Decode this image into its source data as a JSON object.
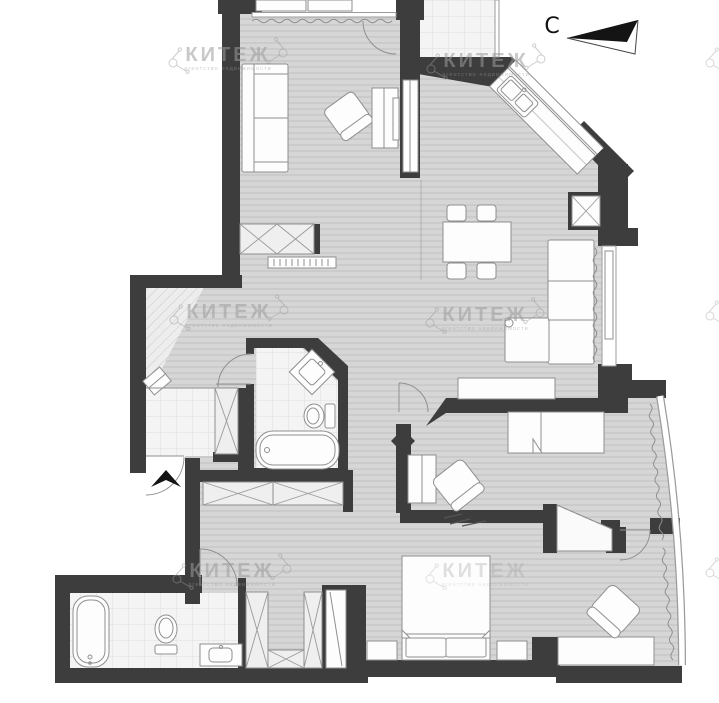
{
  "compass": {
    "label": "С"
  },
  "watermark": {
    "text": "КИТЕЖ",
    "subtitle": "агентство недвижимости"
  },
  "colors": {
    "wall": "#3d3d3d",
    "floor": "#d6d6d6",
    "tile": "#f4f4f4",
    "stroke": "#8f8f8f",
    "wm": "#9c9c9c",
    "ink": "#141414"
  }
}
